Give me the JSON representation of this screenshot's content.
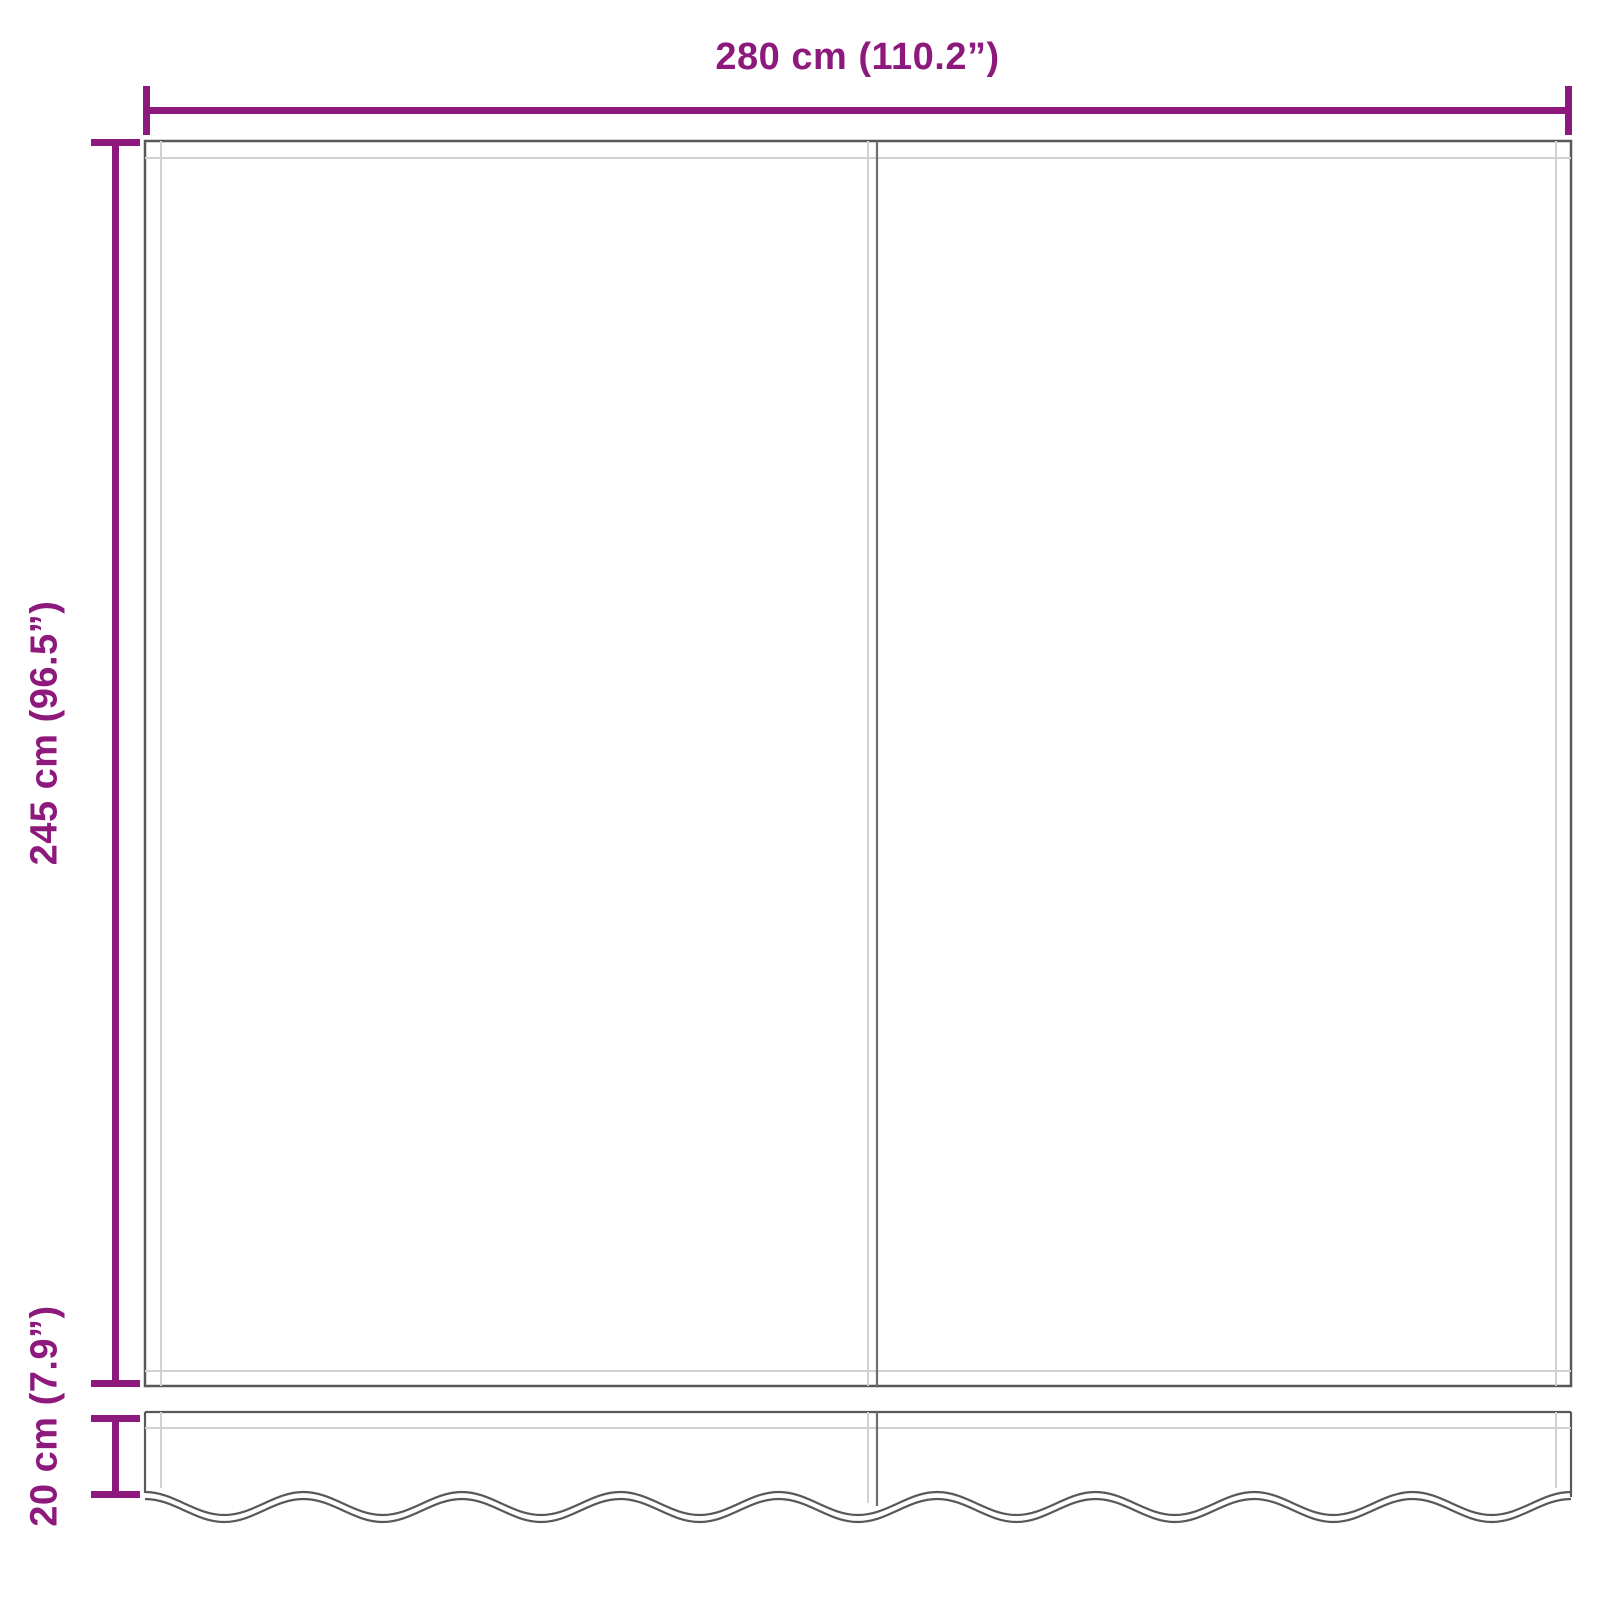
{
  "labels": {
    "width": "280 cm (110.2”)",
    "height": "245 cm (96.5”)",
    "valance_height": "20 cm (7.9”)"
  },
  "colors": {
    "accent": "#8E197D",
    "outline": "#58585A",
    "seam": "#D2D2D2",
    "midline": "#6E6E70"
  }
}
